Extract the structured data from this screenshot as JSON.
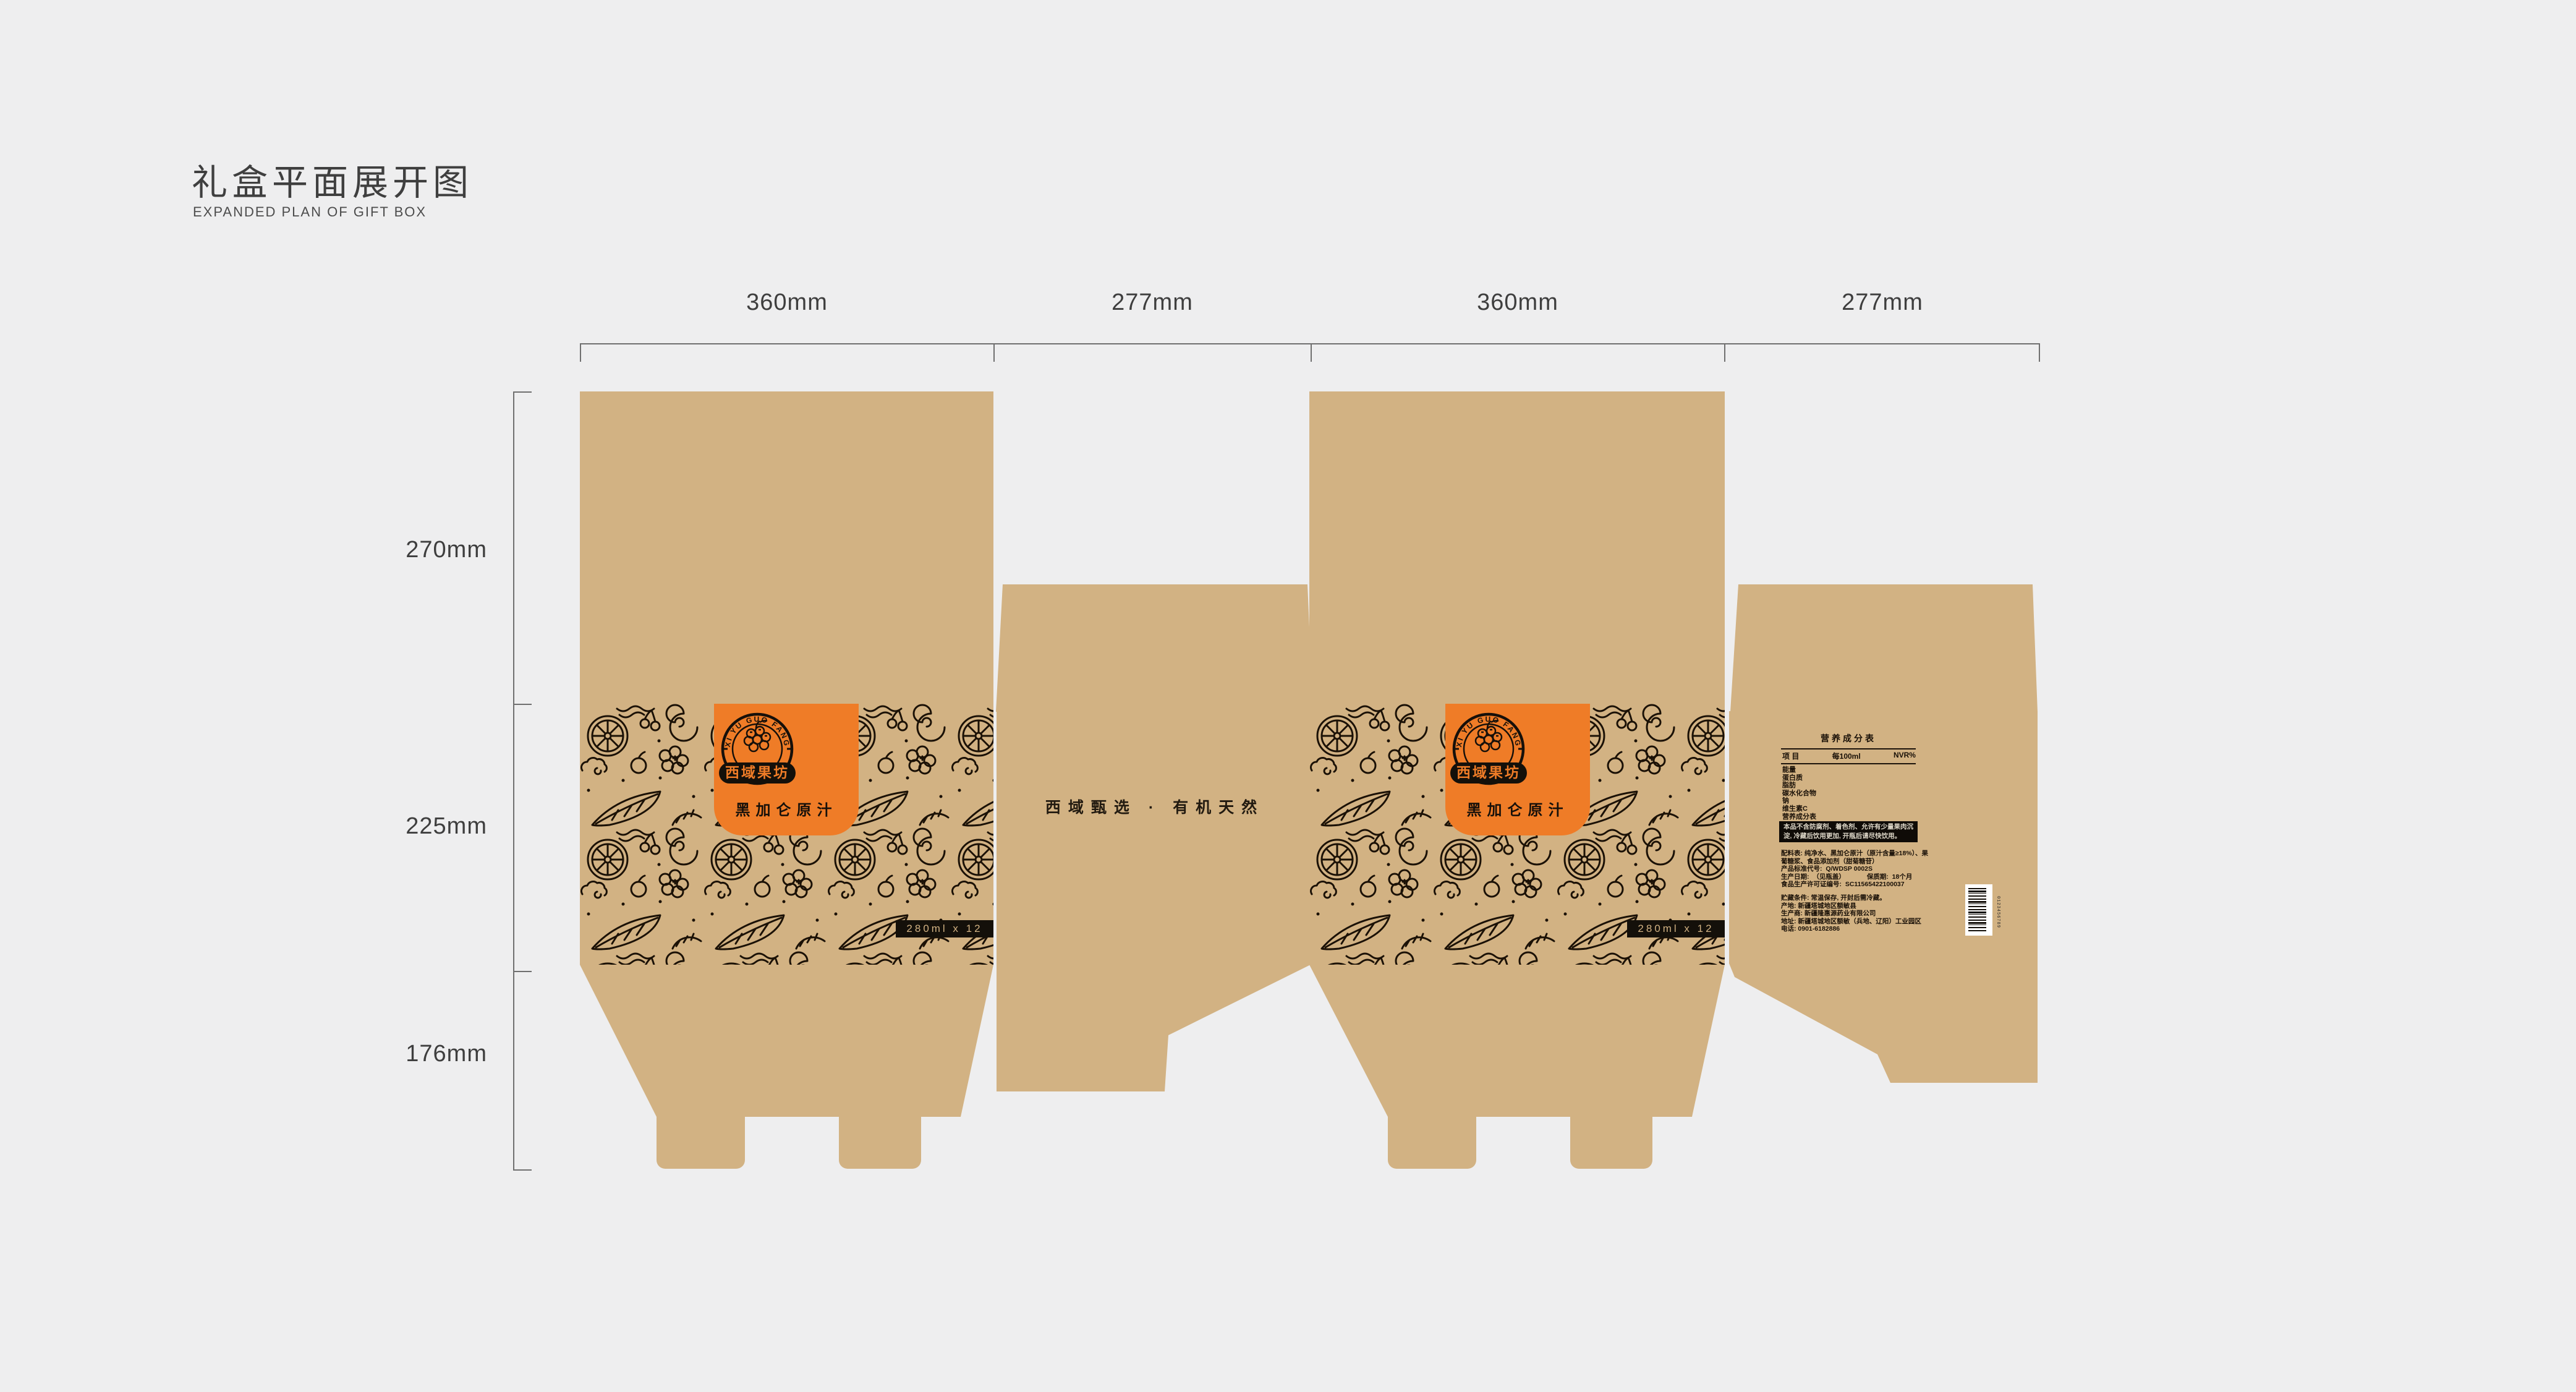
{
  "page": {
    "title_cn": "礼盒平面展开图",
    "title_en": "EXPANDED PLAN OF GIFT BOX"
  },
  "rulers": {
    "top": [
      "360mm",
      "277mm",
      "360mm",
      "277mm"
    ],
    "left": [
      "270mm",
      "225mm",
      "176mm"
    ]
  },
  "brand": {
    "arc_text": "XI YU GUO FANG",
    "name": "西域果坊",
    "product": "黑加仑原汁",
    "slogan": "西域甄选 · 有机天然",
    "pack": "280ml x 12"
  },
  "nutrition": {
    "title": "营养成分表",
    "col_item": "项  目",
    "col_per": "每100ml",
    "col_nvr": "NVR%",
    "rows": [
      "能量",
      "蛋白质",
      "脂肪",
      "碳水化合物",
      "钠",
      "维生素C",
      "营养成分表"
    ]
  },
  "warning": {
    "line1": "本品不含防腐剂、着色剂、允许有少量果肉沉",
    "line2": "淀, 冷藏后饮用更加, 开瓶后请尽快饮用。"
  },
  "info": {
    "lines": [
      "配料表: 纯净水、黑加仑原汁（原汁含量≥18%）、果",
      "葡糖浆、食品添加剂（甜菊糖苷）",
      "产品标准代号:  Q/WDSP 0002S",
      "生产日期:  （见瓶盖）            保质期:  18个月",
      "食品生产许可证编号:  SC11565422100037",
      "",
      "贮藏条件: 常温保存, 开封后需冷藏。",
      "产地: 新疆塔城地区额敏县",
      "生产商: 新疆隆惠源药业有限公司",
      "地址: 新疆塔城地区额敏（兵地、辽阳）工业园区",
      "电话: 0901-6182886"
    ]
  },
  "barcode": {
    "digits": "0123456789"
  },
  "colors": {
    "background": "#eeeeef",
    "kraft": "#d2b283",
    "ink": "#1b1106",
    "orange": "#ef7c27",
    "panel_black": "#14100a",
    "dim_text": "#3e3e3e"
  }
}
